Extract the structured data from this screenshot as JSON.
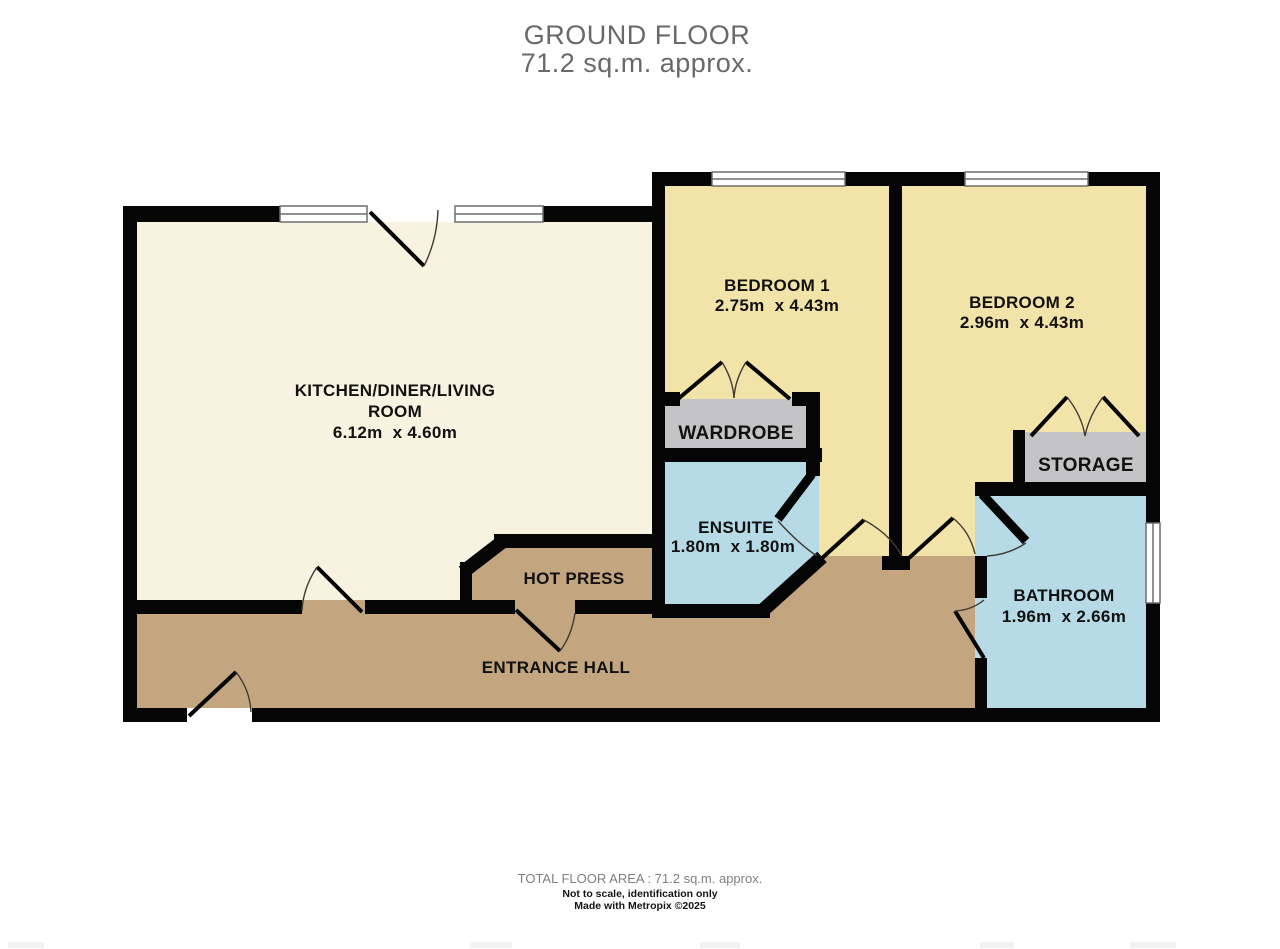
{
  "title": {
    "line1": "GROUND FLOOR",
    "line2": "71.2 sq.m. approx."
  },
  "rooms": {
    "kitchen": {
      "name_line1": "KITCHEN/DINER/LIVING",
      "name_line2": "ROOM",
      "dims": "6.12m  x 4.60m"
    },
    "bedroom1": {
      "name": "BEDROOM 1",
      "dims": "2.75m  x 4.43m"
    },
    "bedroom2": {
      "name": "BEDROOM 2",
      "dims": "2.96m  x 4.43m"
    },
    "ensuite": {
      "name": "ENSUITE",
      "dims": "1.80m  x 1.80m"
    },
    "bathroom": {
      "name": "BATHROOM",
      "dims": "1.96m  x 2.66m"
    },
    "wardrobe": {
      "name": "WARDROBE"
    },
    "storage": {
      "name": "STORAGE"
    },
    "hot_press": {
      "name": "HOT PRESS"
    },
    "entrance_hall": {
      "name": "ENTRANCE HALL"
    }
  },
  "footer": {
    "total_area": "TOTAL FLOOR AREA : 71.2 sq.m. approx.",
    "disclaimer": "Not to scale, identification only",
    "credit": "Made with Metropix ©2025"
  },
  "colors": {
    "living_cream": "#f8f3e0",
    "bedroom_yellow": "#f2e3a8",
    "wet_room_blue": "#b7dbe6",
    "hall_brown": "#c3a57f",
    "closet_gray": "#c4c4c6",
    "wall_black": "#050505",
    "title_gray": "#69696b",
    "footer_gray": "#7f7f82"
  }
}
